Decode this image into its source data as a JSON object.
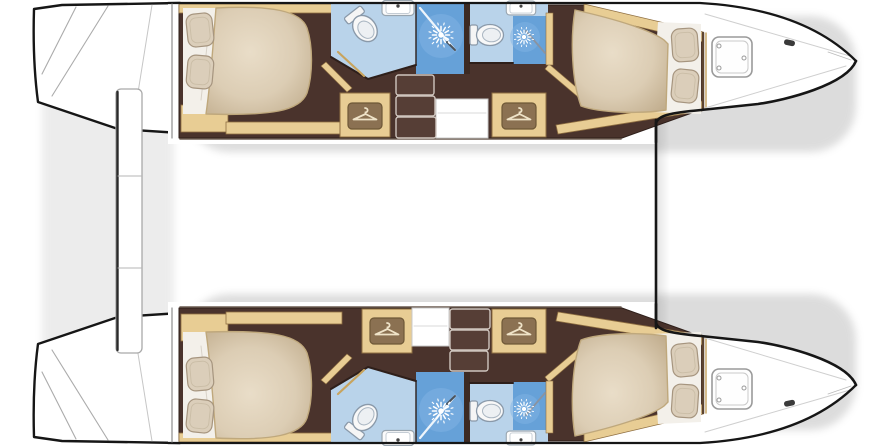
{
  "title": "Catamaran lower-deck floor plan, four cabins with en-suite bathrooms",
  "canvas": {
    "width": 890,
    "height": 446
  },
  "features": {
    "hulls": [
      "port-hull",
      "starboard-hull"
    ],
    "per_hull": [
      "aft-cabin-double-bed",
      "aft-bathroom-toilet-sink",
      "shower-stall",
      "forward-bathroom-toilet-sink",
      "forward-shower-stall",
      "wardrobe",
      "companionway-stairs",
      "forward-cabin-double-bed",
      "bow-deck-hatch"
    ],
    "shared": [
      "transom-steps",
      "stern-platform",
      "bow-crossbeam"
    ]
  },
  "palette": {
    "outline": "#161616",
    "floor": "#4a332c",
    "floorEdge": "#2e1f1a",
    "wood": "#e8cd94",
    "woodEdge": "#8f6f42",
    "blueL": "#b9d3ea",
    "blueM": "#66a1d8",
    "blueHi": "#7fb3e3",
    "sheet": "#f3f0ea",
    "step": "#563e36",
    "stepEdge": "#cfc5be",
    "white": "#ffffff"
  },
  "shapes": {
    "shadows": [
      {
        "name": "hull-shadow",
        "t": "rect",
        "x": 184,
        "y": 16,
        "w": 672,
        "h": 136,
        "rx": 46,
        "fill": "#8e8e8e",
        "opacity": 0.3,
        "blur": true
      },
      {
        "name": "hull-shadow",
        "t": "rect",
        "x": 184,
        "y": 294,
        "w": 672,
        "h": 136,
        "rx": 46,
        "fill": "#8e8e8e",
        "opacity": 0.3,
        "blur": true
      },
      {
        "name": "stern-shadow",
        "t": "rect",
        "x": 42,
        "y": 12,
        "w": 132,
        "h": 422,
        "rx": 18,
        "fill": "#8e8e8e",
        "opacity": 0.16,
        "blur": true
      }
    ],
    "hull": [
      {
        "name": "transom-steps",
        "t": "path",
        "d": "M 34 9 C 33 42 34 72 38 102 L 118 129 L 180 133 L 180 3 L 62 5 Z",
        "fill": "$white",
        "stroke": "$outline",
        "sw": 2.4
      },
      {
        "name": "transom-step-seam",
        "t": "line",
        "x1": 76,
        "y1": 7,
        "x2": 42,
        "y2": 74,
        "stroke": "#ababab",
        "sw": 1.1
      },
      {
        "name": "transom-step-seam",
        "t": "line",
        "x1": 108,
        "y1": 6,
        "x2": 52,
        "y2": 96,
        "stroke": "#ababab",
        "sw": 1.1
      },
      {
        "name": "transom-step-seam",
        "t": "line",
        "x1": 152,
        "y1": 5,
        "x2": 132,
        "y2": 130,
        "stroke": "#c6c6c6",
        "sw": 1
      },
      {
        "name": "hull-body",
        "t": "path",
        "d": "M 168 2 L 700 2 C 770 6 822 26 857 61 C 846 86 786 101 758 105 L 701 111 C 668 114 657 117 655 124 L 655 144 L 168 144 Z",
        "fill": "$white"
      },
      {
        "name": "cabin-sole",
        "t": "path",
        "d": "M 179 5 L 586 5 L 703 33 L 703 109 L 622 138 L 179 138 Z",
        "fill": "$floor",
        "stroke": "$floorEdge",
        "sw": 1
      },
      {
        "name": "trim-outboard-aft",
        "t": "rect",
        "x": 179,
        "y": 4,
        "w": 157,
        "h": 9,
        "fill": "$wood",
        "stroke": "$woodEdge",
        "sw": 0.8
      },
      {
        "name": "trim-outboard-fwd",
        "t": "path",
        "d": "M 584 4 L 703 32 L 703 42 L 584 14 Z",
        "fill": "$wood",
        "stroke": "$woodEdge",
        "sw": 0.8
      },
      {
        "name": "aft-cabin-locker",
        "t": "rect",
        "x": 181,
        "y": 105,
        "w": 47,
        "h": 27,
        "fill": "$wood",
        "stroke": "$woodEdge",
        "sw": 0.8
      },
      {
        "name": "trim-inboard-aft",
        "t": "rect",
        "x": 226,
        "y": 122,
        "w": 116,
        "h": 12,
        "fill": "$wood",
        "stroke": "$woodEdge",
        "sw": 0.8
      },
      {
        "name": "trim-inboard-fwd",
        "t": "path",
        "d": "M 556 125 L 702 101 L 702 111 L 558 134 Z",
        "fill": "$wood",
        "stroke": "$woodEdge",
        "sw": 0.8
      },
      {
        "name": "corridor-wall",
        "t": "path",
        "d": "M 321 66 L 347 92 L 352 88 L 326 62 Z",
        "fill": "$wood",
        "stroke": "$woodEdge",
        "sw": 0.6
      },
      {
        "name": "corridor-wall",
        "t": "path",
        "d": "M 549 64 L 583 93 L 578 97 L 545 69 Z",
        "fill": "$wood",
        "stroke": "$woodEdge",
        "sw": 0.6
      },
      {
        "name": "aft-bathroom-floor",
        "t": "path",
        "d": "M 331 4 L 416 4 L 416 64 L 368 79 L 331 57 Z",
        "fill": "$blueL"
      },
      {
        "name": "shower-stall",
        "t": "rect",
        "x": 416,
        "y": 4,
        "w": 50,
        "h": 70,
        "fill": "$blueM"
      },
      {
        "name": "shower-glow",
        "t": "circle",
        "cx": 441,
        "cy": 36,
        "r": 22,
        "fill": "$blueHi",
        "opacity": 0.55
      },
      {
        "name": "partition-wall",
        "t": "rect",
        "x": 464,
        "y": 3,
        "w": 6,
        "h": 71,
        "fill": "#3c2a23"
      },
      {
        "name": "fwd-bathroom-floor",
        "t": "path",
        "d": "M 470 4 L 548 4 L 548 16 L 513 16 L 513 63 L 470 63 Z",
        "fill": "$blueL"
      },
      {
        "name": "shower-stall",
        "t": "rect",
        "x": 513,
        "y": 16,
        "w": 35,
        "h": 48,
        "fill": "$blueM"
      },
      {
        "name": "shower-glow",
        "t": "circle",
        "cx": 525,
        "cy": 37,
        "r": 15,
        "fill": "$blueHi",
        "opacity": 0.5
      },
      {
        "name": "shower-wall",
        "t": "rect",
        "x": 546,
        "y": 13,
        "w": 7,
        "h": 52,
        "fill": "$wood",
        "stroke": "$woodEdge",
        "sw": 0.6
      },
      {
        "name": "bathroom-wall",
        "t": "path",
        "d": "M 331 57 L 368 79 L 416 65",
        "fill": "none",
        "stroke": "$floorEdge",
        "sw": 2
      },
      {
        "name": "bathroom-wall",
        "t": "line",
        "x1": 470,
        "y1": 63,
        "x2": 513,
        "y2": 63,
        "stroke": "$floorEdge",
        "sw": 2
      },
      {
        "name": "partition-line",
        "t": "line",
        "x1": 416,
        "y1": 4,
        "x2": 416,
        "y2": 64,
        "stroke": "$floorEdge",
        "sw": 1.4
      },
      {
        "name": "shower-door-glass",
        "t": "line",
        "x1": 420,
        "y1": 8,
        "x2": 455,
        "y2": 50,
        "stroke": "#eef5fb",
        "sw": 2.2
      },
      {
        "name": "shower-door-handle",
        "t": "line",
        "x1": 447,
        "y1": 42,
        "x2": 455,
        "y2": 50,
        "stroke": "#49525c",
        "sw": 2
      },
      {
        "name": "shower-door-glass",
        "t": "line",
        "x1": 526,
        "y1": 31,
        "x2": 545,
        "y2": 53,
        "stroke": "#8a93a0",
        "sw": 1.8
      },
      {
        "name": "bathroom-door",
        "t": "line",
        "x1": 338,
        "y1": 52,
        "x2": 364,
        "y2": 76,
        "stroke": "#c8a45e",
        "sw": 2.2
      },
      {
        "name": "toilet-icon",
        "t": "icon",
        "icon": "toilet",
        "x": 363,
        "y": 26,
        "rot": 52,
        "s": 1.05
      },
      {
        "name": "toilet-icon",
        "t": "icon",
        "icon": "toilet",
        "x": 487,
        "y": 35,
        "rot": 0,
        "s": 1
      },
      {
        "name": "sink-icon",
        "t": "icon",
        "icon": "sink",
        "x": 398,
        "y": 8,
        "rot": 0,
        "s": 1
      },
      {
        "name": "sink-icon",
        "t": "icon",
        "icon": "sink",
        "x": 521,
        "y": 8,
        "rot": 0,
        "s": 0.92
      },
      {
        "name": "shower-head-icon",
        "t": "icon",
        "icon": "shower",
        "x": 441,
        "y": 35,
        "rot": 0,
        "s": 1
      },
      {
        "name": "shower-head-icon",
        "t": "icon",
        "icon": "shower",
        "x": 524,
        "y": 37,
        "rot": 0,
        "s": 0.8
      },
      {
        "name": "bed-sheet",
        "t": "path",
        "d": "M 183 8 L 216 8 L 210 114 L 183 114 Z",
        "fill": "$sheet"
      },
      {
        "name": "sheet-fold",
        "t": "line",
        "x1": 209,
        "y1": 28,
        "x2": 201,
        "y2": 100,
        "stroke": "#d8d2c8",
        "sw": 1
      },
      {
        "name": "bed-duvet",
        "t": "path",
        "d": "M 216 8 C 272 5 301 11 307 28 C 313 46 313 74 307 93 C 300 111 272 116 206 114 C 211 80 213 44 216 8 Z",
        "fill": "url(#bedGrad)",
        "stroke": "#bfa87c",
        "sw": 1.4
      },
      {
        "name": "pillow-icon",
        "t": "icon",
        "icon": "pillow",
        "x": 200,
        "y": 30,
        "rot": -6,
        "s": 1
      },
      {
        "name": "pillow-icon",
        "t": "icon",
        "icon": "pillow",
        "x": 200,
        "y": 72,
        "rot": 5,
        "s": 1
      },
      {
        "name": "bed-sheet",
        "t": "path",
        "d": "M 658 22 L 701 24 L 701 114 L 652 112 Z",
        "fill": "$sheet"
      },
      {
        "name": "bed-duvet",
        "t": "path",
        "d": "M 575 10 C 620 20 652 31 664 40 L 668 44 L 666 110 C 640 114 600 113 581 106 C 572 82 570 40 575 10 Z",
        "fill": "url(#bedGrad)",
        "stroke": "#bfa87c",
        "sw": 1.4
      },
      {
        "name": "pillow-icon",
        "t": "icon",
        "icon": "pillow",
        "x": 685,
        "y": 45,
        "rot": -4,
        "s": 1
      },
      {
        "name": "pillow-icon",
        "t": "icon",
        "icon": "pillow",
        "x": 685,
        "y": 86,
        "rot": 6,
        "s": 1
      },
      {
        "name": "bulkhead",
        "t": "line",
        "x1": 703,
        "y1": 33,
        "x2": 703,
        "y2": 109,
        "stroke": "#5d4430",
        "sw": 2.5
      },
      {
        "name": "bulkhead-trim",
        "t": "line",
        "x1": 706,
        "y1": 33,
        "x2": 706,
        "y2": 109,
        "stroke": "#caa86a",
        "sw": 1.5
      },
      {
        "name": "deck-seam",
        "t": "line",
        "x1": 705,
        "y1": 14,
        "x2": 850,
        "y2": 56,
        "stroke": "#cfcfcf",
        "sw": 1
      },
      {
        "name": "deck-seam",
        "t": "line",
        "x1": 705,
        "y1": 108,
        "x2": 846,
        "y2": 66,
        "stroke": "#cfcfcf",
        "sw": 1
      },
      {
        "name": "deck-seam",
        "t": "line",
        "x1": 828,
        "y1": 52,
        "x2": 851,
        "y2": 60,
        "stroke": "#bbbbbb",
        "sw": 0.8
      },
      {
        "name": "bow-hatch",
        "t": "rect",
        "x": 712,
        "y": 37,
        "w": 40,
        "h": 40,
        "rx": 7,
        "fill": "#fefefe",
        "stroke": "#9a9a9a",
        "sw": 1.6
      },
      {
        "name": "bow-hatch-inner",
        "t": "rect",
        "x": 716,
        "y": 41,
        "w": 32,
        "h": 32,
        "rx": 5,
        "fill": "none",
        "stroke": "#c9c9c9",
        "sw": 1
      },
      {
        "name": "hatch-hinge",
        "t": "circle",
        "cx": 719,
        "cy": 46,
        "r": 2,
        "fill": "#ffffff",
        "stroke": "#9a9a9a",
        "sw": 1
      },
      {
        "name": "hatch-hinge",
        "t": "circle",
        "cx": 719,
        "cy": 68,
        "r": 2,
        "fill": "#ffffff",
        "stroke": "#9a9a9a",
        "sw": 1
      },
      {
        "name": "hatch-hinge",
        "t": "circle",
        "cx": 744,
        "cy": 58,
        "r": 2,
        "fill": "#ffffff",
        "stroke": "#9a9a9a",
        "sw": 1
      },
      {
        "name": "bow-cleat",
        "t": "rect",
        "x": 784,
        "y": 40,
        "w": 11,
        "h": 5.5,
        "rx": 2.5,
        "rot": 12,
        "fill": "#3a3a3a"
      },
      {
        "name": "hull-outline-outboard",
        "t": "path",
        "d": "M 168 3 L 700 3 C 770 7 822 27 856 61",
        "fill": "none",
        "stroke": "$outline",
        "sw": 2.3
      },
      {
        "name": "hull-outline-bow",
        "t": "path",
        "d": "M 856 61 C 846 85 786 100 758 104 L 701 110 C 668 113 658 116 656 123 L 656 142",
        "fill": "none",
        "stroke": "$outline",
        "sw": 2.6
      },
      {
        "name": "hull-stern-edge",
        "t": "line",
        "x1": 172,
        "y1": 4,
        "x2": 172,
        "y2": 138,
        "stroke": "#8d8d8d",
        "sw": 1.2
      },
      {
        "name": "hull-inboard-edge",
        "t": "line",
        "x1": 180,
        "y1": 139,
        "x2": 621,
        "y2": 139,
        "stroke": "#6b5b50",
        "sw": 1.5
      }
    ],
    "stern": [
      {
        "name": "stern-platform",
        "t": "rect",
        "x": 116,
        "y": 89,
        "w": 26,
        "h": 264,
        "rx": 5,
        "fill": "$white",
        "stroke": "#a9a9a9",
        "sw": 1.3
      },
      {
        "name": "stern-platform-edge",
        "t": "line",
        "x1": 117.5,
        "y1": 92,
        "x2": 117.5,
        "y2": 350,
        "stroke": "#2a2a2a",
        "sw": 2.4
      },
      {
        "name": "stern-platform-seam",
        "t": "line",
        "x1": 118,
        "y1": 176,
        "x2": 141,
        "y2": 176,
        "stroke": "#b5b5b5",
        "sw": 1
      },
      {
        "name": "stern-platform-seam",
        "t": "line",
        "x1": 118,
        "y1": 268,
        "x2": 141,
        "y2": 268,
        "stroke": "#b5b5b5",
        "sw": 1
      },
      {
        "name": "bow-crossbeam",
        "t": "line",
        "x1": 656,
        "y1": 120,
        "x2": 656,
        "y2": 328,
        "stroke": "$outline",
        "sw": 2.6
      },
      {
        "name": "bow-crossbeam-shade",
        "t": "rect",
        "x": 657,
        "y": 120,
        "w": 13,
        "h": 208,
        "fill": "url(#fadeR)"
      }
    ],
    "fittings_top": [
      {
        "name": "wardrobe",
        "t": "rect",
        "x": 340,
        "y": 93,
        "w": 50,
        "h": 44,
        "fill": "$wood",
        "stroke": "$woodEdge",
        "sw": 1
      },
      {
        "name": "wardrobe",
        "t": "rect",
        "x": 492,
        "y": 93,
        "w": 54,
        "h": 44,
        "fill": "$wood",
        "stroke": "$woodEdge",
        "sw": 1
      },
      {
        "name": "hanger-icon",
        "t": "icon",
        "icon": "hanger",
        "x": 365,
        "y": 116,
        "rot": 0,
        "s": 1
      },
      {
        "name": "hanger-icon",
        "t": "icon",
        "icon": "hanger",
        "x": 519,
        "y": 116,
        "rot": 0,
        "s": 1
      },
      {
        "name": "stair-landing",
        "t": "rect",
        "x": 436,
        "y": 99,
        "w": 52,
        "h": 39,
        "fill": "$white",
        "stroke": "#c8c8c8",
        "sw": 1
      },
      {
        "name": "landing-seam",
        "t": "line",
        "x1": 438,
        "y1": 113,
        "x2": 486,
        "y2": 113,
        "stroke": "#d8d8d8",
        "sw": 1
      },
      {
        "name": "stair-step",
        "t": "rect",
        "x": 396,
        "y": 75,
        "w": 38,
        "h": 20,
        "rx": 2.5,
        "fill": "$step",
        "stroke": "$stepEdge",
        "sw": 1.4
      },
      {
        "name": "stair-step",
        "t": "rect",
        "x": 396,
        "y": 96,
        "w": 39,
        "h": 20,
        "rx": 2.5,
        "fill": "$step",
        "stroke": "$stepEdge",
        "sw": 1.4
      },
      {
        "name": "stair-step",
        "t": "rect",
        "x": 396,
        "y": 117,
        "w": 40,
        "h": 21,
        "rx": 2.5,
        "fill": "$step",
        "stroke": "$stepEdge",
        "sw": 1.4
      }
    ],
    "fittings_bottom": [
      {
        "name": "wardrobe",
        "t": "rect",
        "x": 362,
        "y": 309,
        "w": 50,
        "h": 44,
        "fill": "$wood",
        "stroke": "$woodEdge",
        "sw": 1
      },
      {
        "name": "wardrobe",
        "t": "rect",
        "x": 492,
        "y": 309,
        "w": 54,
        "h": 44,
        "fill": "$wood",
        "stroke": "$woodEdge",
        "sw": 1
      },
      {
        "name": "hanger-icon",
        "t": "icon",
        "icon": "hanger",
        "x": 387,
        "y": 331,
        "rot": 0,
        "s": 1
      },
      {
        "name": "hanger-icon",
        "t": "icon",
        "icon": "hanger",
        "x": 519,
        "y": 331,
        "rot": 0,
        "s": 1
      },
      {
        "name": "stair-landing",
        "t": "rect",
        "x": 412,
        "y": 308,
        "w": 37,
        "h": 38,
        "fill": "$white",
        "stroke": "#c8c8c8",
        "sw": 1
      },
      {
        "name": "landing-seam",
        "t": "line",
        "x1": 414,
        "y1": 326,
        "x2": 447,
        "y2": 326,
        "stroke": "#d8d8d8",
        "sw": 1
      },
      {
        "name": "stair-step",
        "t": "rect",
        "x": 450,
        "y": 309,
        "w": 40,
        "h": 20,
        "rx": 2.5,
        "fill": "$step",
        "stroke": "$stepEdge",
        "sw": 1.4
      },
      {
        "name": "stair-step",
        "t": "rect",
        "x": 450,
        "y": 330,
        "w": 39,
        "h": 20,
        "rx": 2.5,
        "fill": "$step",
        "stroke": "$stepEdge",
        "sw": 1.4
      },
      {
        "name": "stair-step",
        "t": "rect",
        "x": 450,
        "y": 351,
        "w": 38,
        "h": 20,
        "rx": 2.5,
        "fill": "$step",
        "stroke": "$stepEdge",
        "sw": 1.4
      }
    ]
  }
}
